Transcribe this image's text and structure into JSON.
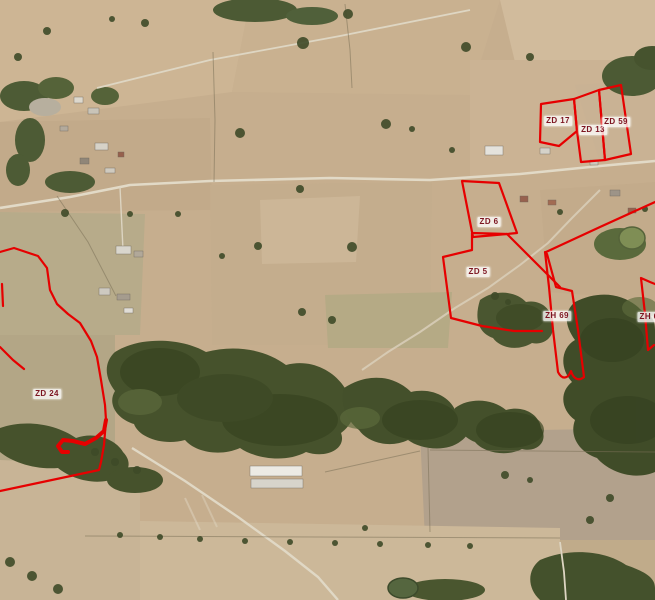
{
  "map": {
    "description": "Aerial cadastral map with highlighted parcels",
    "overlay": {
      "outline_color": "#e60000",
      "label_text_color": "#7c1420",
      "label_background": "#ffffff"
    },
    "parcels": [
      {
        "id": "zd17",
        "label": "ZD 17",
        "x": 558,
        "y": 121
      },
      {
        "id": "zd13",
        "label": "ZD 13",
        "x": 593,
        "y": 130
      },
      {
        "id": "zd59",
        "label": "ZD 59",
        "x": 616,
        "y": 122
      },
      {
        "id": "zd6",
        "label": "ZD 6",
        "x": 489,
        "y": 222
      },
      {
        "id": "zd5",
        "label": "ZD 5",
        "x": 478,
        "y": 272
      },
      {
        "id": "zh69",
        "label": "ZH 69",
        "x": 557,
        "y": 316
      },
      {
        "id": "zh6",
        "label": "ZH 6",
        "x": 649,
        "y": 317
      },
      {
        "id": "zd24",
        "label": "ZD 24",
        "x": 47,
        "y": 394
      }
    ]
  }
}
